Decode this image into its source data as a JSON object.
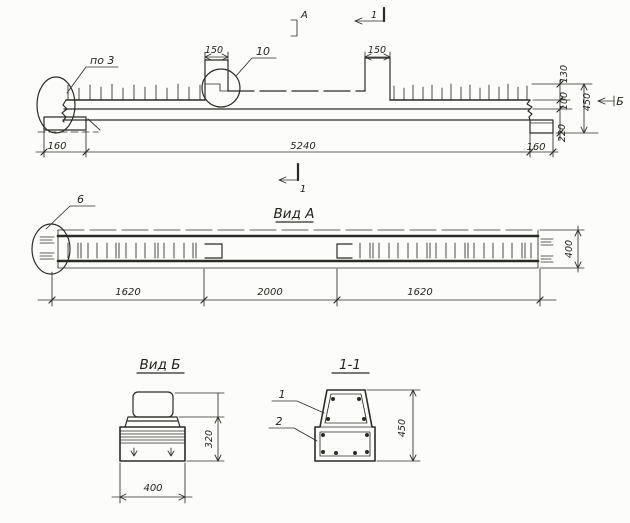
{
  "drawing": {
    "elevation": {
      "callout_end": "по 3",
      "callout_console": "10",
      "view_mark_top": "А",
      "section_mark_top": "1",
      "section_mark_bottom": "1",
      "view_mark_side": "Б",
      "dim_console_left": "150",
      "dim_console_right": "150",
      "dim_end_left": "160",
      "dim_span": "5240",
      "dim_end_right": "160",
      "dim_outstand": "130",
      "dim_upper": "100",
      "dim_total_height": "450",
      "dim_lower": "220"
    },
    "view_a": {
      "title": "Вид А",
      "callout_end": "6",
      "dim_left": "1620",
      "dim_middle": "2000",
      "dim_right": "1620",
      "dim_width": "400"
    },
    "view_b": {
      "title": "Вид Б",
      "dim_height": "320",
      "dim_width": "400"
    },
    "section_1_1": {
      "title": "1-1",
      "callout_outer": "1",
      "callout_inner": "2",
      "dim_height": "450"
    }
  }
}
